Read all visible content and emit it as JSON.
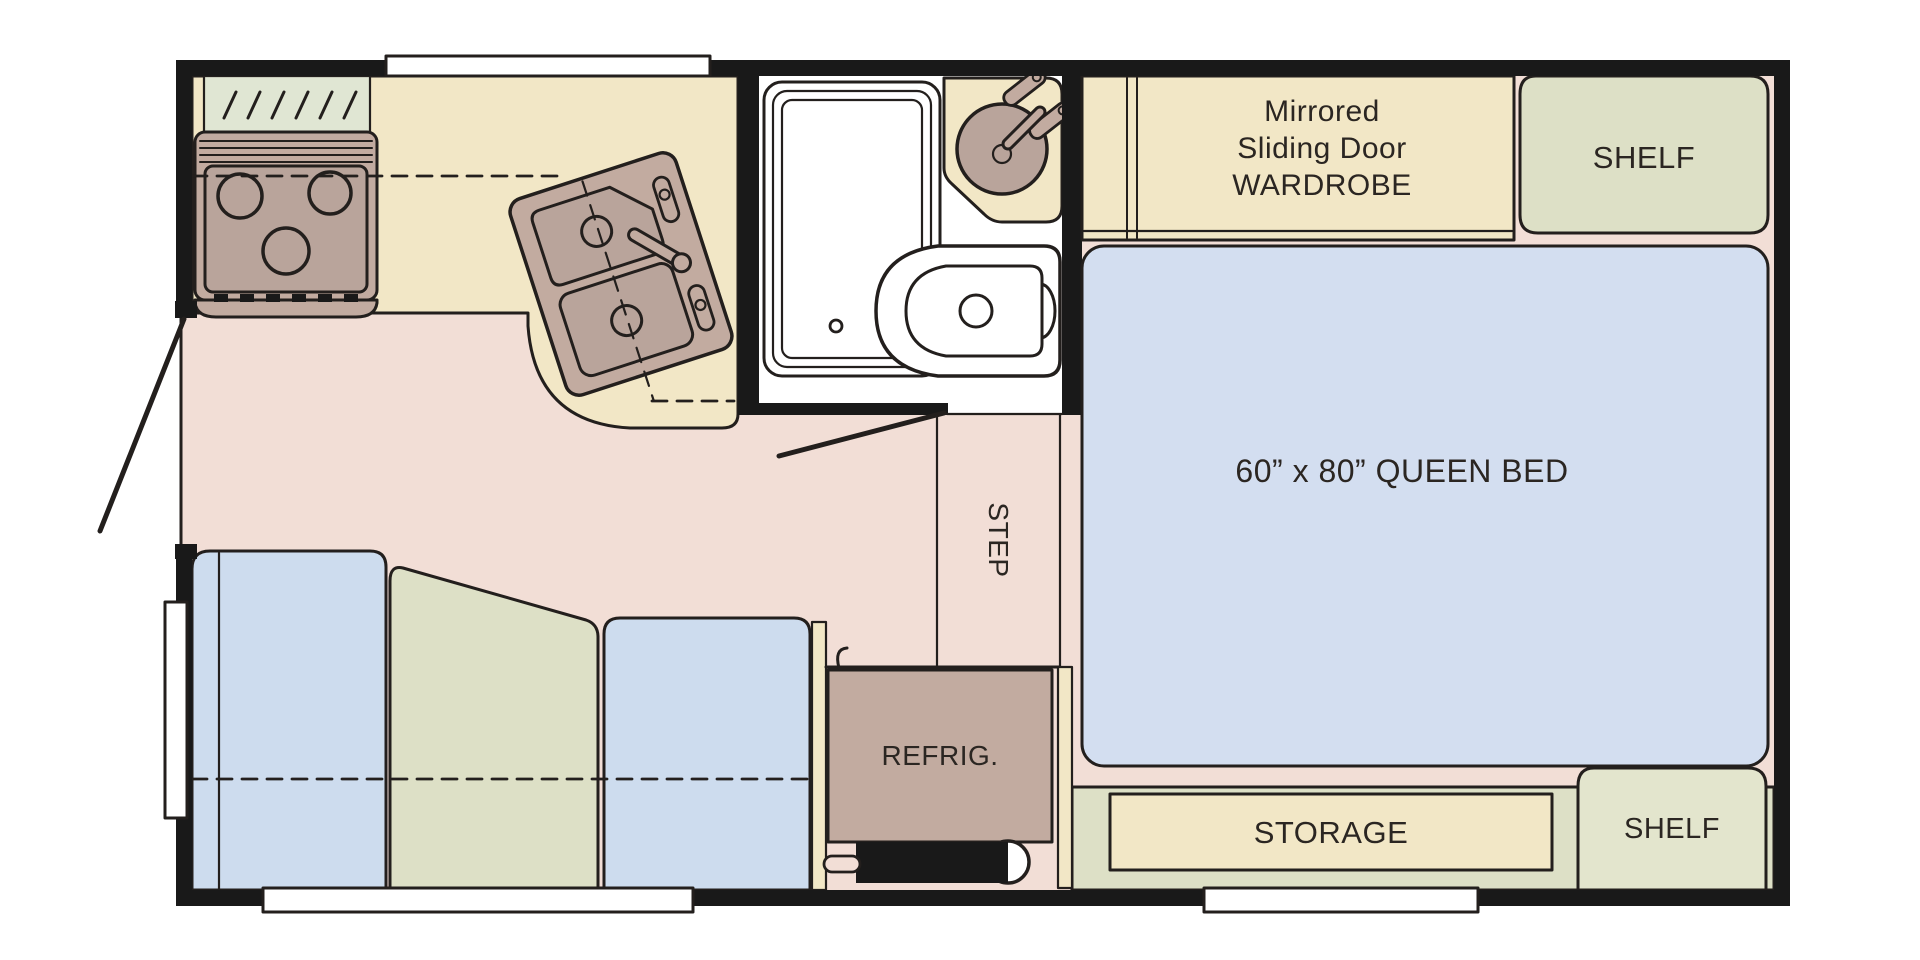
{
  "plan": {
    "labels": {
      "wardrobe_line1": "Mirrored",
      "wardrobe_line2": "Sliding Door",
      "wardrobe_line3": "WARDROBE",
      "shelf_top": "SHELF",
      "queen_bed": "60” x 80” QUEEN BED",
      "step": "STEP",
      "refrigerator": "REFRIG.",
      "storage": "STORAGE",
      "shelf_bottom": "SHELF"
    },
    "colors": {
      "wall": "#191919",
      "outline": "#231f1d",
      "floor": "#f2ded6",
      "cream": "#f2e7c6",
      "sage": "#dde0c6",
      "sage_light": "#e3e5cd",
      "green_pale": "#e0e6d3",
      "mauve": "#c2aba0",
      "mauve_deep": "#b9a49b",
      "bed_blue": "#d3def0",
      "seat_blue": "#cddcee",
      "bath_white": "#ffffff",
      "text": "#2b2622"
    }
  }
}
